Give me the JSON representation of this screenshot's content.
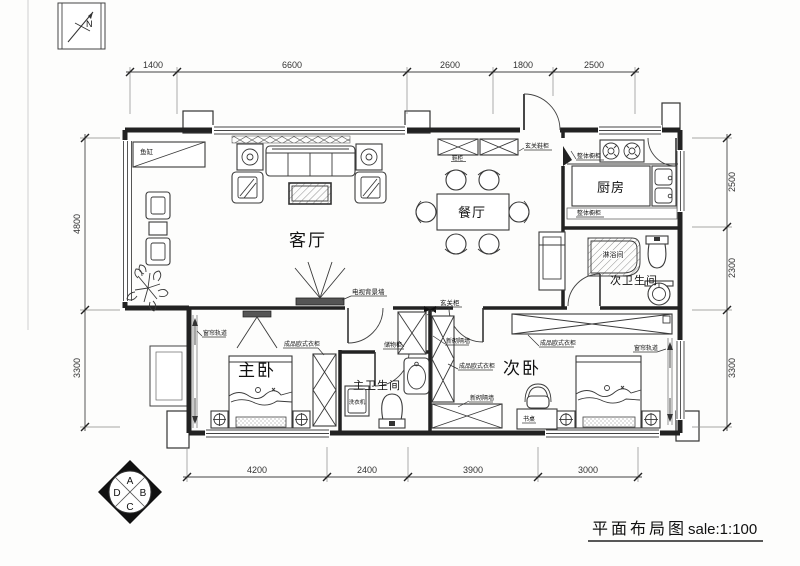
{
  "title": {
    "name": "平面布局图",
    "scale": "sale:1:100"
  },
  "compass": {
    "label": "N"
  },
  "rooms": {
    "living": "客厅",
    "dining": "餐厅",
    "kitchen": "厨房",
    "master_bedroom": "主卧",
    "second_bedroom": "次卧",
    "master_bath": "主卫生间",
    "second_bath": "次卫生间",
    "shower": "淋浴间"
  },
  "labels": {
    "fish_tank": "鱼缸",
    "shoe_cabinet": "鞋柜",
    "entry_shoe_cabinet": "玄关鞋柜",
    "tv_wall": "电视背景墙",
    "kitchen_cabinet_top": "整体橱柜",
    "kitchen_cabinet_bottom": "整体橱柜",
    "entry_cabinet": "玄关柜",
    "storage_cabinet": "储物柜",
    "washing_machine": "洗衣机",
    "desk": "书桌",
    "master_wardrobe": "成品欧式衣柜",
    "second_wardrobe_left": "成品欧式衣柜",
    "second_wardrobe_top": "成品欧式衣柜",
    "new_wall_top": "新砌隔墙",
    "new_wall_bottom": "新砌隔墙",
    "curtain_track_left": "窗帘轨道",
    "curtain_track_right": "窗帘轨道"
  },
  "dimensions": {
    "top": [
      "1400",
      "6600",
      "2600",
      "1800",
      "2500"
    ],
    "bottom": [
      "4200",
      "2400",
      "3900",
      "3000"
    ],
    "left": [
      "4800",
      "3300"
    ],
    "right": [
      "2500",
      "2300",
      "3300"
    ]
  },
  "elevation_marker": {
    "top": "A",
    "right": "B",
    "bottom": "C",
    "left": "D"
  }
}
